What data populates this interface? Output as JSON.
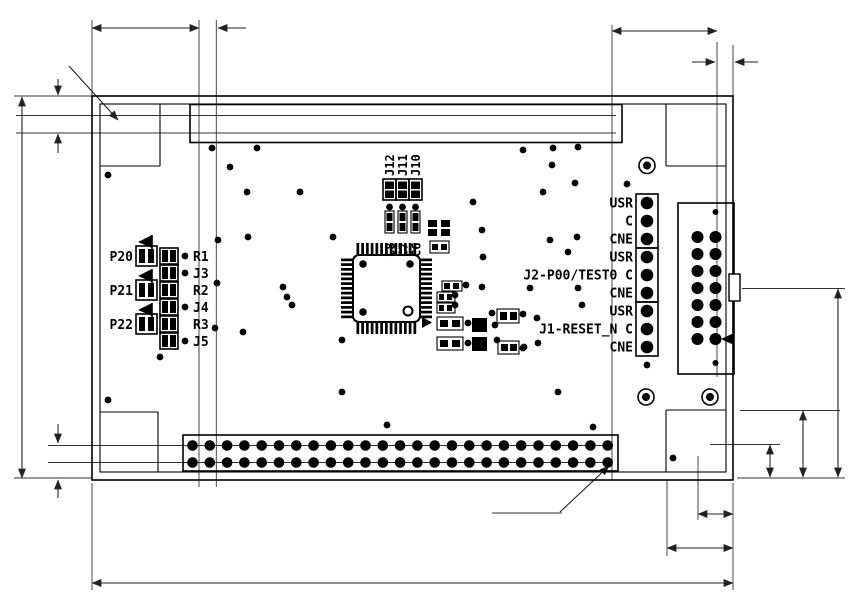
{
  "dimensions": {
    "top_width": "15.24",
    "top_pitch": "2.54",
    "top_right_width": "17.78",
    "top_right_margin": "2.54",
    "hole_callout": "4- ø3.6",
    "left_edge_top": "2.54",
    "left_pitch_top": "2.54",
    "board_height": "55.88",
    "left_pitch_bottom": "2.54",
    "left_edge_bottom": "2.54",
    "right_height": "27.94",
    "right_offset_10": "10",
    "right_offset_508": "5.08",
    "bottom_offset_508": "5.08",
    "bottom_offset_10": "10",
    "board_width": "93.98",
    "hole_dia": "ø0.8"
  },
  "connectors": {
    "cn1": {
      "label": "CN1",
      "cols": 25,
      "pin_tl": "49",
      "pin_bl": "50",
      "pin_tr": "1",
      "pin_br": "2"
    },
    "cn2": {
      "label": "CN2",
      "cols": 25,
      "pin_tl": "2",
      "pin_bl": "1",
      "pin_tr": "50",
      "pin_br": "49"
    },
    "cne": {
      "label": "CNE",
      "rows": 7,
      "pin_top_l": "14",
      "pin_top_r": "13",
      "pin_bot_l": "2",
      "pin_bot_r": "1"
    }
  },
  "power": {
    "uvdd": "UVDD",
    "pwr": "PWR",
    "vdd": "VDD",
    "vss": "VSS"
  },
  "headers": {
    "rows": [
      "USR",
      "C",
      "CNE",
      "USR",
      "J2-P00/TEST0 C",
      "CNE",
      "USR",
      "J1-RESET_N C",
      "CNE"
    ],
    "j2": "J2",
    "j1": "J1"
  },
  "ic": {
    "ref": "U1",
    "pin26": "26",
    "pin27": "27",
    "pin39": "39",
    "pin40": "40",
    "pin52": "52",
    "pin13": "13"
  },
  "components": {
    "top_jumpers": [
      "J12",
      "J11",
      "J10"
    ],
    "caps": [
      "C8",
      "C7",
      "C6"
    ],
    "j9": "J9",
    "j8": "J8",
    "c5": "C5",
    "r4": "R4",
    "c2": "C2",
    "c1": "C1",
    "c4": "C4",
    "c3": "C3",
    "x1": "X1",
    "j7": "J7",
    "j6": "J6",
    "ports": [
      "P20",
      "P21",
      "P22"
    ],
    "refs": [
      "R1",
      "J3",
      "R2",
      "J4",
      "R3",
      "J5"
    ]
  },
  "silkscreen": {
    "rohm": "ROHM GROUP",
    "lapis": "LAPIS",
    "semi": "SEMICONDUCTOR",
    "model": "QTU-11860",
    "part": "RB-D62Q1712TB52",
    "note": "L1 BEBKST"
  },
  "vias": [
    [
      212,
      148
    ],
    [
      257,
      148
    ],
    [
      523,
      150
    ],
    [
      553,
      148
    ],
    [
      578,
      147
    ],
    [
      230,
      167
    ],
    [
      552,
      165
    ],
    [
      108,
      175
    ],
    [
      247,
      192
    ],
    [
      300,
      192
    ],
    [
      543,
      192
    ],
    [
      575,
      183
    ],
    [
      473,
      202
    ],
    [
      218,
      240
    ],
    [
      248,
      237
    ],
    [
      550,
      240
    ],
    [
      577,
      237
    ],
    [
      482,
      230
    ],
    [
      333,
      237
    ],
    [
      568,
      252
    ],
    [
      483,
      257
    ],
    [
      283,
      287
    ],
    [
      287,
      297
    ],
    [
      292,
      305
    ],
    [
      482,
      287
    ],
    [
      530,
      288
    ],
    [
      578,
      288
    ],
    [
      582,
      305
    ],
    [
      243,
      332
    ],
    [
      342,
      340
    ],
    [
      537,
      318
    ],
    [
      523,
      348
    ],
    [
      538,
      343
    ],
    [
      342,
      392
    ],
    [
      558,
      392
    ],
    [
      160,
      357
    ],
    [
      108,
      400
    ],
    [
      387,
      425
    ],
    [
      593,
      427
    ],
    [
      673,
      458
    ],
    [
      647,
      365
    ],
    [
      217,
      283
    ],
    [
      215,
      328
    ],
    [
      466,
      285
    ],
    [
      455,
      295
    ],
    [
      455,
      305
    ],
    [
      468,
      323
    ],
    [
      468,
      343
    ],
    [
      495,
      325
    ],
    [
      497,
      340
    ],
    [
      492,
      313
    ],
    [
      523,
      314
    ],
    [
      524,
      347
    ],
    [
      185,
      256
    ],
    [
      185,
      273
    ],
    [
      185,
      307
    ],
    [
      185,
      341
    ]
  ]
}
